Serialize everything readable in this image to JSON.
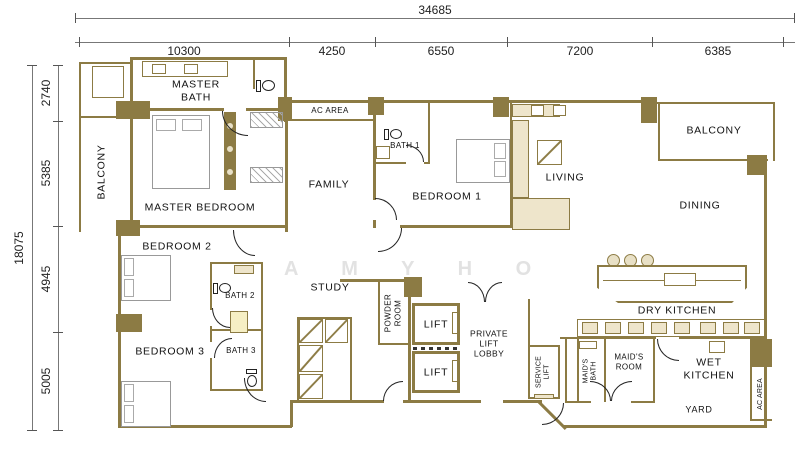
{
  "dimensions": {
    "top_total": "34685",
    "top_segments": [
      "10300",
      "4250",
      "6550",
      "7200",
      "6385"
    ],
    "left_total": "18075",
    "left_segments": [
      "2740",
      "5385",
      "4945",
      "5005"
    ]
  },
  "rooms": {
    "balcony_left": "BALCONY",
    "master_bath": "MASTER\nBATH",
    "master_bedroom": "MASTER BEDROOM",
    "ac_area_top": "AC AREA",
    "family": "FAMILY",
    "bath1": "BATH 1",
    "bedroom1": "BEDROOM 1",
    "living": "LIVING",
    "balcony_right": "BALCONY",
    "dining": "DINING",
    "bedroom2": "BEDROOM 2",
    "bath2": "BATH 2",
    "bedroom3": "BEDROOM 3",
    "bath3": "BATH 3",
    "study": "STUDY",
    "powder_room": "POWDER\nROOM",
    "lift_upper": "LIFT",
    "lift_lower": "LIFT",
    "private_lift_lobby": "PRIVATE\nLIFT\nLOBBY",
    "service_lift": "SERVICE\nLIFT",
    "maids_bath": "MAID'S\nBATH",
    "maids_room": "MAID'S\nROOM",
    "dry_kitchen": "DRY KITCHEN",
    "wet_kitchen": "WET\nKITCHEN",
    "yard": "YARD",
    "ac_area_right": "AC AREA"
  },
  "watermark": "A M Y  H O",
  "colors": {
    "wall": "#8c7b44",
    "fixture_line": "#222222",
    "counter_fill": "#eee5cb",
    "shaft_fill": "#f6efc4",
    "watermark": "#e2e2e2"
  }
}
